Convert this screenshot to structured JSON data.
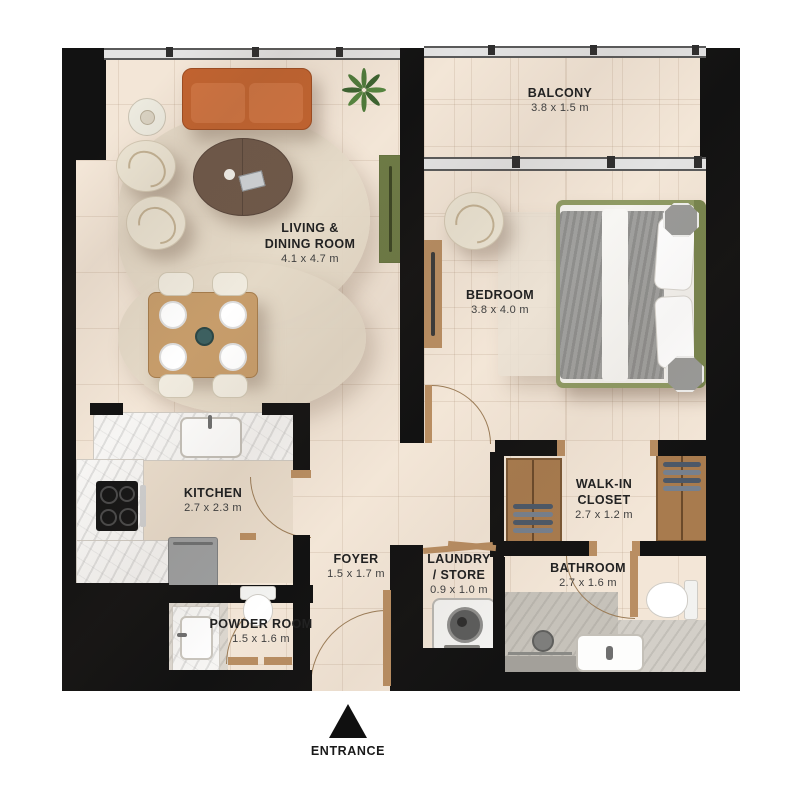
{
  "plan": {
    "title": "one-bedroom apartment floor plan",
    "rooms": {
      "balcony": {
        "name": "BALCONY",
        "dims": "3.8 x 1.5 m"
      },
      "living": {
        "line1": "LIVING &",
        "line2": "DINING ROOM",
        "dims": "4.1 x 4.7 m"
      },
      "bedroom": {
        "name": "BEDROOM",
        "dims": "3.8 x 4.0 m"
      },
      "kitchen": {
        "name": "KITCHEN",
        "dims": "2.7 x 2.3 m"
      },
      "walk_in_closet": {
        "line1": "WALK-IN",
        "line2": "CLOSET",
        "dims": "2.7 x 1.2 m"
      },
      "bathroom": {
        "name": "BATHROOM",
        "dims": "2.7 x 1.6 m"
      },
      "foyer": {
        "name": "FOYER",
        "dims": "1.5 x 1.7 m"
      },
      "laundry": {
        "line1": "LAUNDRY",
        "line2": "/ STORE",
        "dims": "0.9 x 1.0 m"
      },
      "powder_room": {
        "name": "POWDER ROOM",
        "dims": "1.5 x 1.6 m"
      }
    },
    "entrance": {
      "label": "ENTRANCE"
    },
    "colors": {
      "wall": "#121212",
      "floor": "#f3e6d7",
      "wood": "#b98e62",
      "sofa": "#c2632f",
      "bed_frame": "#8f9a63",
      "console": "#6d7a45"
    }
  }
}
